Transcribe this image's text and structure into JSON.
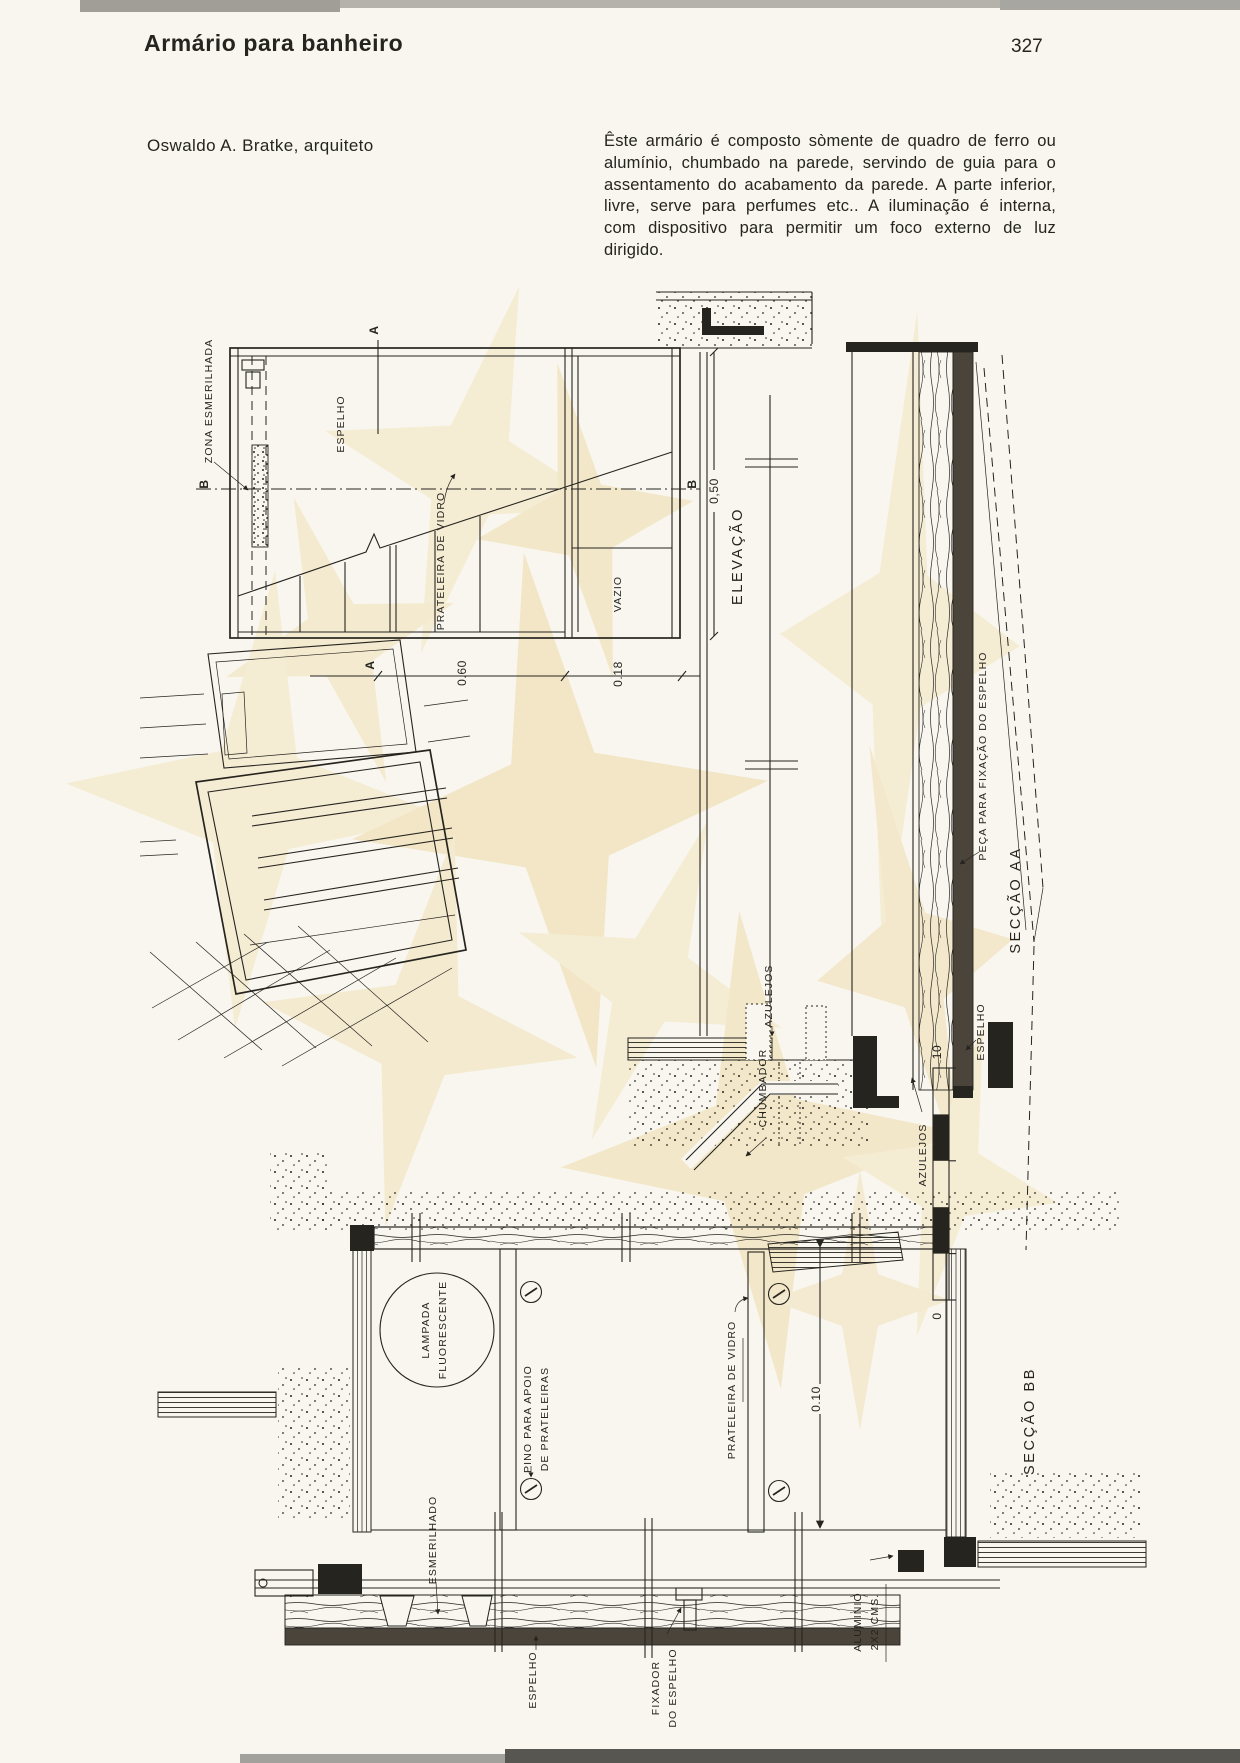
{
  "page": {
    "title": "Armário para banheiro",
    "page_number": "327",
    "author": "Oswaldo A. Bratke, arquiteto",
    "intro": "Êste armário é composto sòmente de quadro de ferro ou alumínio, chumbado na parede, servindo de guia para o assentamento do acabamento da parede.  A parte inferior, livre, serve para perfumes etc..  A iluminação é interna, com dispositivo para permitir um foco externo de luz dirigido."
  },
  "elevation": {
    "title": "ELEVAÇÃO",
    "marker_a": "A",
    "marker_b": "B",
    "dim_width": "0.60",
    "dim_side": "0.18",
    "dim_height": "0,50",
    "labels": {
      "zona_esmerilhada": "ZONA ESMERILHADA",
      "espelho": "ESPELHO",
      "prateleira_vidro": "PRATELEIRA DE VIDRO",
      "vazio": "VAZIO"
    }
  },
  "section_aa": {
    "title": "SECÇÃO AA",
    "labels": {
      "peca_fixacao": "PEÇA PARA FIXAÇÃO DO ESPELHO",
      "azulejos_parede": "AZULEJOS",
      "espelho": "ESPELHO",
      "chumbador": "CHUMBADOR",
      "azulejos_piso": "AZULEJOS"
    }
  },
  "section_bb": {
    "title": "SECÇÃO BB",
    "dim_profundidade": "0.10",
    "scale_max": "10",
    "scale_min": "0",
    "labels": {
      "lampada_1": "LAMPADA",
      "lampada_2": "FLUORESCENTE",
      "pino_1": "PINO PARA APOIO",
      "pino_2": "DE PRATELEIRAS",
      "prateleira_vidro": "PRATELEIRA DE VIDRO",
      "esmerilhado": "ESMERILHADO",
      "espelho": "ESPELHO",
      "fixador_1": "FIXADOR",
      "fixador_2": "DO ESPELHO",
      "aluminio_1": "ALUMINIO",
      "aluminio_2": "2X2 CMS."
    }
  },
  "colors": {
    "paper": "#f8f6ef",
    "ink": "#26241f",
    "watermark": "#f3e7c8"
  }
}
